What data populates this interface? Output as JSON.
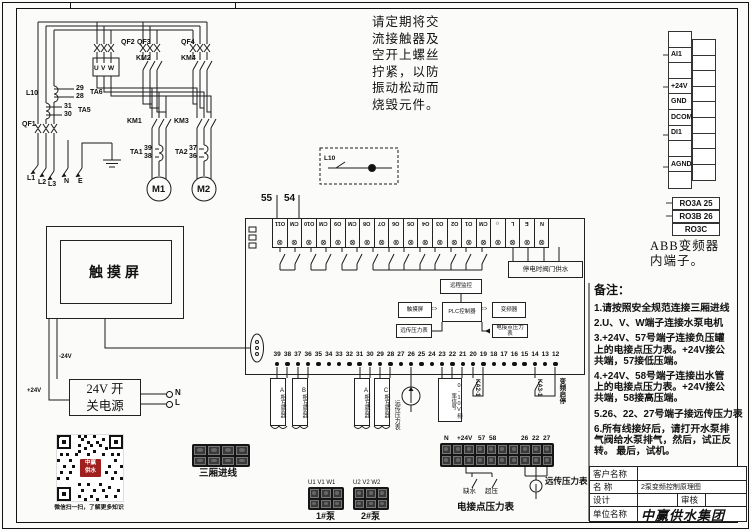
{
  "note": {
    "text": "请定期将交\n流接触器及\n空开上螺丝\n拧紧，以防\n振动松动而\n烧毁元件。"
  },
  "power": {
    "qf1": "QF1",
    "qf2": "QF2",
    "qf3": "QF3",
    "qf4": "QF4",
    "km1": "KM1",
    "km2": "KM2",
    "km3": "KM3",
    "km4": "KM4",
    "ta1": "TA1",
    "ta2": "TA2",
    "ta5": "TA5",
    "ta6": "TA6",
    "n29": "29",
    "n28": "28",
    "n31": "31",
    "n30": "30",
    "n39": "39",
    "n38": "38",
    "n37": "37",
    "n36": "36",
    "l10": "L10",
    "u": "U",
    "v": "V",
    "w": "W",
    "m1": "M1",
    "m2": "M2",
    "l1": "L1",
    "l2": "L2",
    "l3": "L3",
    "n": "N",
    "e": "E",
    "lamp_box_label": "L10"
  },
  "plc": {
    "n55": "55",
    "n54": "54",
    "top_terminals": [
      "O11",
      "CM",
      "O10",
      "CM",
      "O9",
      "CM",
      "O8",
      "O7",
      "O6",
      "O5",
      "O4",
      "O3",
      "O2",
      "O1",
      "CM",
      "☼",
      "L",
      "E",
      "N"
    ],
    "bottom_terminals": [
      "39",
      "38",
      "37",
      "36",
      "35",
      "34",
      "33",
      "32",
      "31",
      "30",
      "29",
      "28",
      "27",
      "26",
      "25",
      "24",
      "23",
      "22",
      "21",
      "20",
      "19",
      "18",
      "17",
      "16",
      "15",
      "14",
      "13",
      "12"
    ],
    "supply_box": "停电时阀门供水",
    "ct_labels": [
      "A相互感器",
      "B相互感器",
      "A相互感器",
      "C相互感器"
    ],
    "gauge_label": "远传压力表",
    "signal_box": "0-10V频率信号",
    "ka2": "KA2-1",
    "ka3": "KA3-1",
    "vfd_startstop": "变频启停"
  },
  "flow": {
    "top": "远程监控",
    "left": "触摸屏",
    "bottom_left": "远传压力表",
    "center": "PLC控制器",
    "right": "变频器",
    "bottom_right": "电接点压力表"
  },
  "abb": {
    "left_cells": [
      "",
      "AI1",
      "",
      "+24V",
      "GND",
      "DCOM",
      "DI1",
      "",
      "AGND",
      ""
    ],
    "right_cells": [
      "",
      "",
      "",
      "",
      "",
      "",
      "",
      "",
      ""
    ],
    "relay_cells": [
      "RO3A 25",
      "RO3B 26",
      "RO3C"
    ],
    "caption": "ABB变频器\n内端子。"
  },
  "touch": {
    "label": "触摸屏"
  },
  "psu": {
    "label": "24V 开\n关电源",
    "n": "N",
    "l": "L",
    "plus24": "+24V",
    "minus24": "-24V"
  },
  "qr": {
    "caption": "微信扫一扫，了解更多知识",
    "badge": "中赢\n供水"
  },
  "bottom": {
    "incoming_label": "三厢进线",
    "incoming_cells": [
      "",
      "",
      "",
      ""
    ],
    "pump_cells": [
      "",
      "",
      ""
    ],
    "strip_cells": [
      "",
      "",
      "",
      "",
      "",
      "",
      "",
      "",
      "",
      ""
    ],
    "pump1_terms": "U1 V1 W1",
    "pump1": "1#泵",
    "pump2_terms": "U2 V2 W2",
    "pump2": "2#泵",
    "strip_labels": {
      "n": "N",
      "v24": "+24V",
      "t57": "57",
      "t58": "58",
      "t26": "26",
      "t22": "22",
      "t27": "27"
    },
    "lack_water": "缺水",
    "over_pressure": "超压",
    "contact_gauge": "电接点压力表",
    "remote_gauge": "远传压力表"
  },
  "remarks": {
    "title": "备注：",
    "items": [
      "1.请按照安全规范连接三厢进线",
      "2.U、V、W端子连接水泵电机",
      "3.+24V、57号端子连接负压罐\n上的电接点压力表。+24V接公\n共端，57接低压端。",
      "4.+24V、58号端子连接出水管\n上的电接点压力表。+24V接公\n共端，58接高压端。",
      "5.26、22、27号端子接远传压力表",
      "6.所有线接好后，请打开水泵排\n气阀给水泵排气，然后，试正反\n转。 最后，试机。"
    ]
  },
  "titleblock": {
    "customer_label": "客户名称",
    "customer_value": "",
    "name_label": "名  称",
    "name_value": "2泵变频控制原理图",
    "design_label": "设计",
    "design_value": "",
    "review_label": "审核",
    "review_value": "",
    "unit_label": "单位名称",
    "unit_value": "中赢供水集团"
  }
}
